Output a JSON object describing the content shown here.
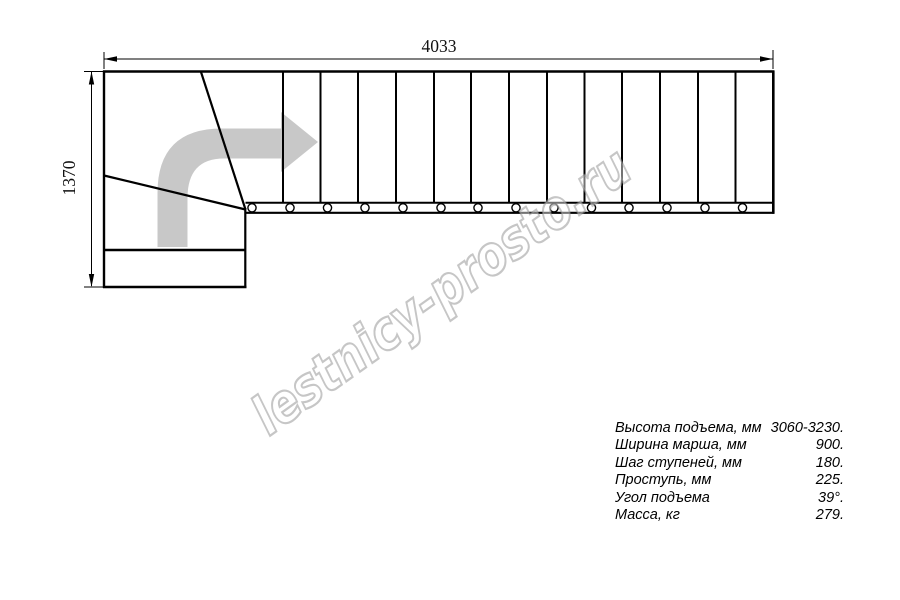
{
  "drawing": {
    "type": "stair-plan-top-view-l-shaped",
    "dimensions": {
      "total_length": "4033",
      "total_width": "1370"
    },
    "straight_flight_tread_count": 14,
    "winder_tread_count": 3,
    "direction_arrow": "turn-from-bottom-to-right",
    "colors": {
      "line": "#000000",
      "arrow_fill": "#c8c8c8",
      "watermark_outline": "#979797",
      "background": "#ffffff"
    }
  },
  "watermark": {
    "text": "lestnicy-prosto.ru"
  },
  "specs": {
    "rows": [
      {
        "label": "Высота подъема, мм",
        "value": "3060-3230."
      },
      {
        "label": "Ширина марша, мм",
        "value": "900."
      },
      {
        "label": "Шаг ступеней, мм",
        "value": "180."
      },
      {
        "label": "Проступь, мм",
        "value": "225."
      },
      {
        "label": "Угол подъема",
        "value": "39°."
      },
      {
        "label": "Масса, кг",
        "value": "279."
      }
    ]
  }
}
